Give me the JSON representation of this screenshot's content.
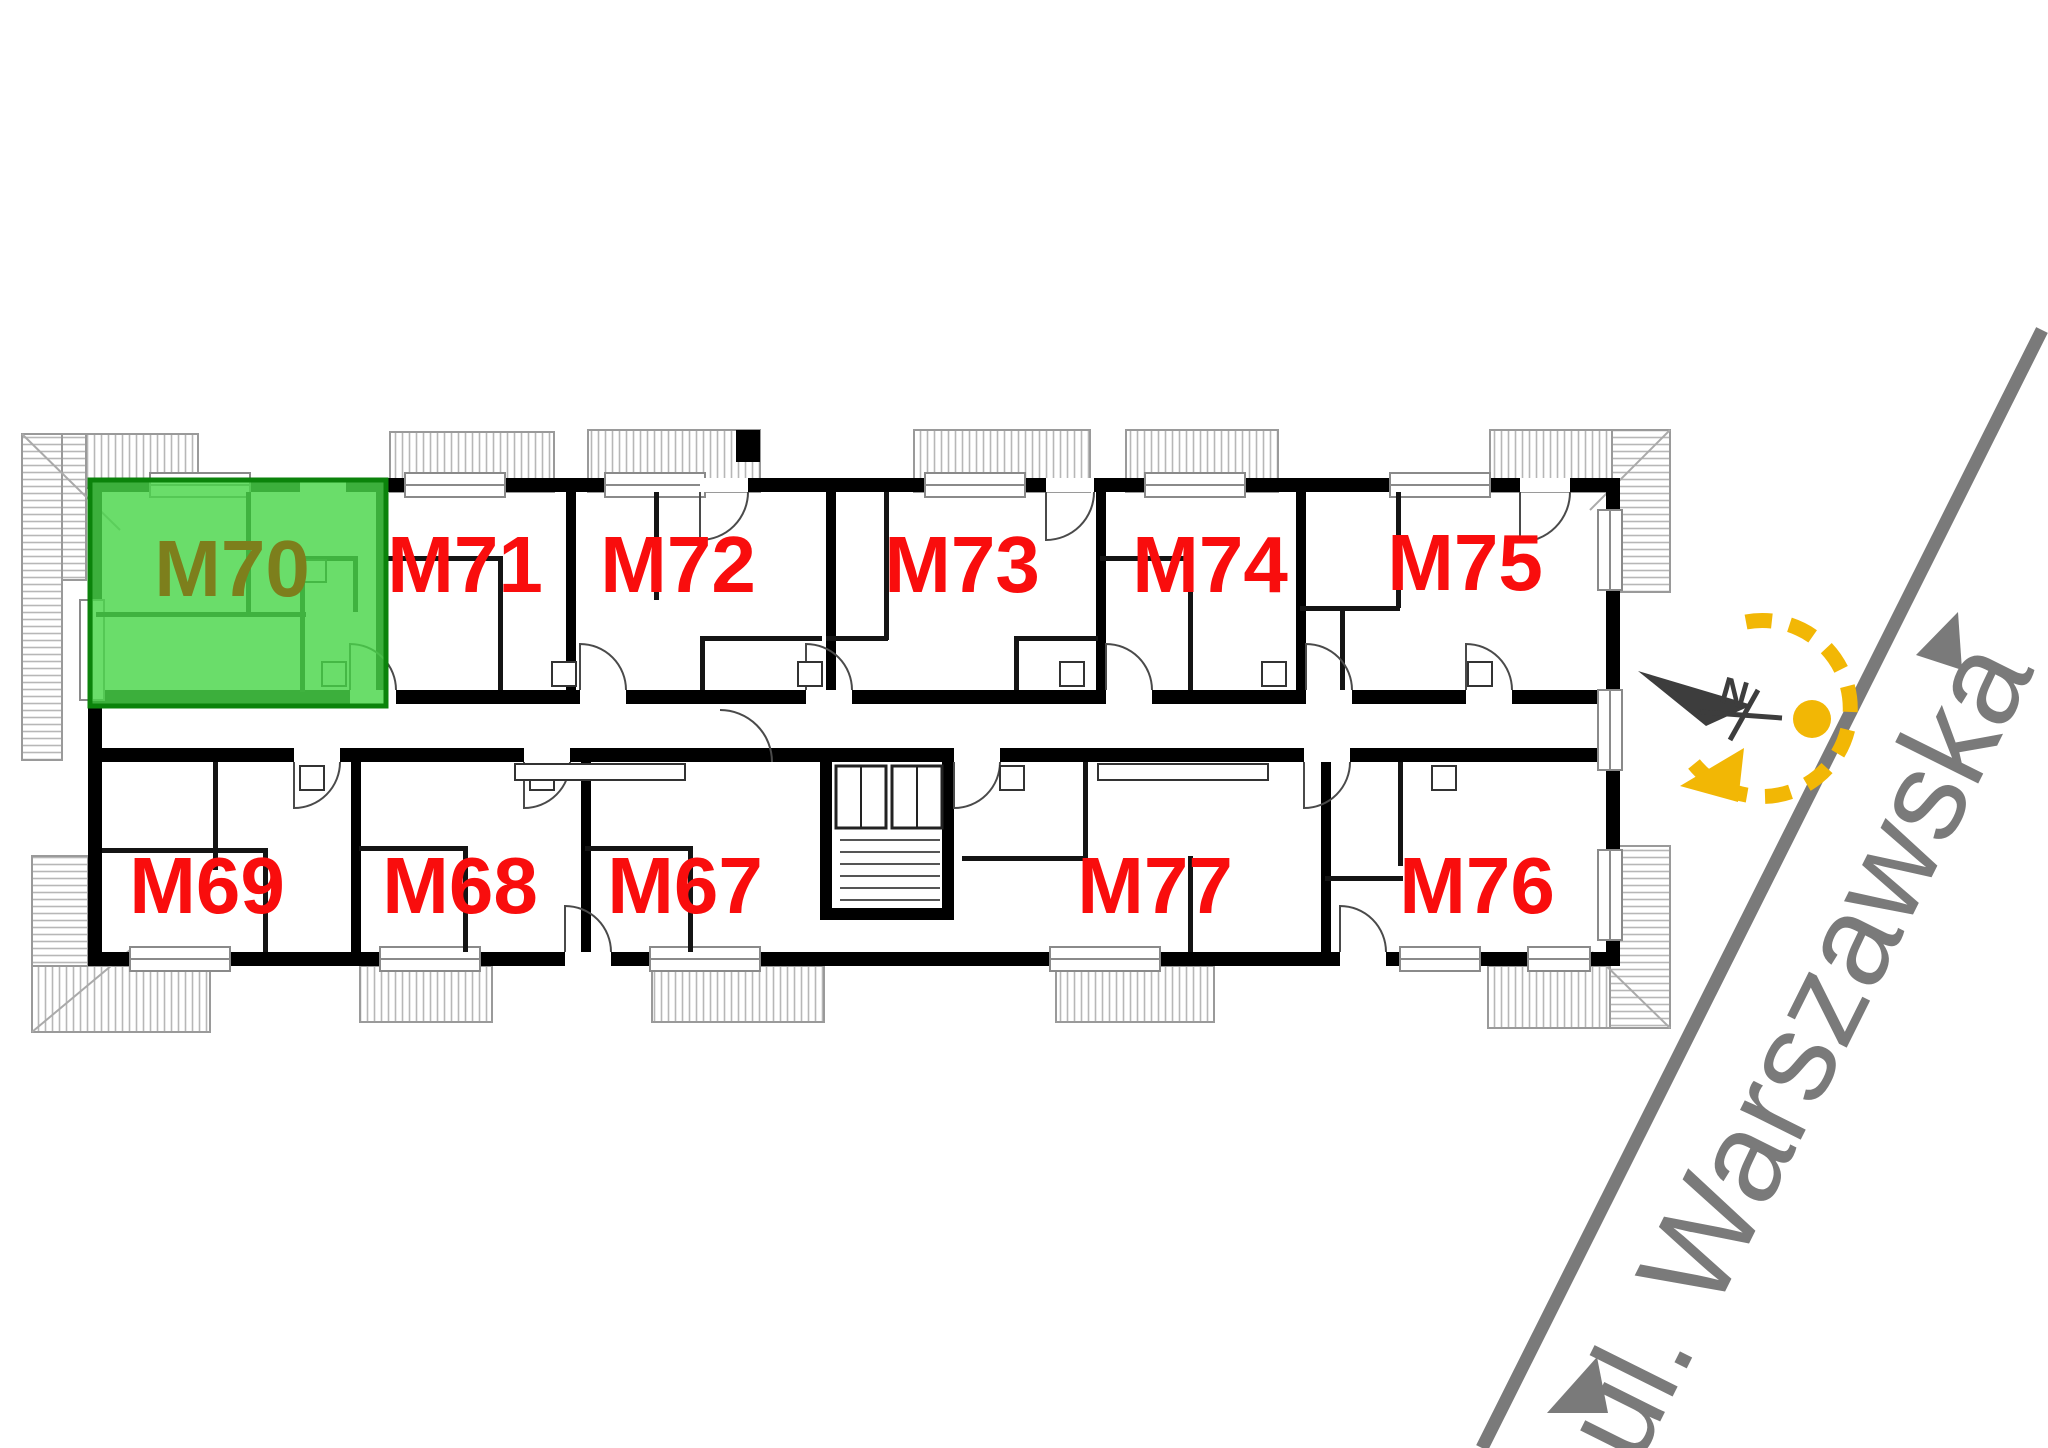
{
  "plan": {
    "street_name": "ul. Warszawska",
    "compass_north_label": "N",
    "highlighted_unit": "M70",
    "units": {
      "m70": "M70",
      "m71": "M71",
      "m72": "M72",
      "m73": "M73",
      "m74": "M74",
      "m75": "M75",
      "m69": "M69",
      "m68": "M68",
      "m67": "M67",
      "m77": "M77",
      "m76": "M76"
    },
    "colors": {
      "highlight_fill": "#49d549",
      "highlight_border": "#0b830b",
      "highlight_label": "#7d7f1c",
      "unit_label": "#f90d0d",
      "wall": "#000000",
      "street": "#7a7a7a",
      "compass_needle": "#3d3d3d",
      "compass_accent": "#f2b705"
    }
  }
}
